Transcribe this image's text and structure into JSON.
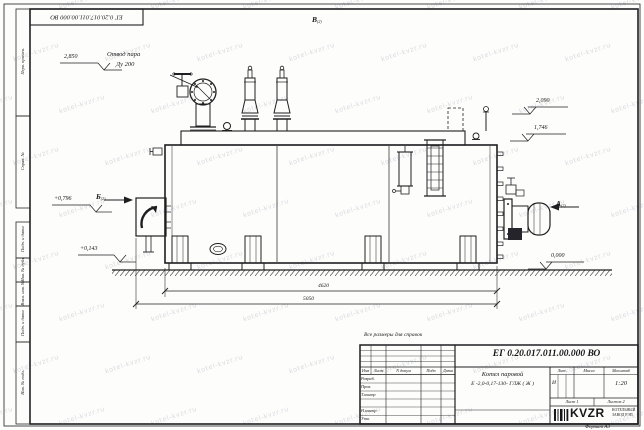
{
  "watermark": {
    "text": "kotel-kvzr.ru"
  },
  "corner_stamp": {
    "doc_number": "ЕГ 0.20.017.011.00.000  ВО"
  },
  "margin": {
    "boxes": [
      {
        "label": "Перв. примен."
      },
      {
        "label": "Справ. №"
      },
      {
        "label": "Подп. и дата"
      },
      {
        "label": "Инв. № дубл."
      },
      {
        "label": "Взам. инв. №"
      },
      {
        "label": "Подп. и дата"
      },
      {
        "label": "Инв. № подл."
      }
    ]
  },
  "views": {
    "top": {
      "letter": "В",
      "sheet": "(2)"
    },
    "left": {
      "letter": "Б",
      "sheet": "(2)"
    },
    "right": {
      "letter": "А",
      "sheet": "(2)"
    }
  },
  "callouts": {
    "steam_line1": "Отвод пара",
    "steam_line2": "Ду 200"
  },
  "levels": {
    "steam": "2,850",
    "top": "2,090",
    "shell": "1,746",
    "left_upper": "+0,796",
    "left_lower": "+0,143",
    "ground": "0,000"
  },
  "dimensions": {
    "inner": "4620",
    "overall": "5050"
  },
  "notes": {
    "reference": "Все размеры для справок"
  },
  "title_block": {
    "doc_number": "ЕГ 0.20.017.011.00.000  ВО",
    "product_name_line1": "Котел паровой",
    "product_name_line2": "Е -2,0-0,17-130- ГЛЖ ( Ж )",
    "columns": {
      "izm": "Изм",
      "list": "Лист",
      "n_docum": "N докум",
      "podp": "Подп",
      "data": "Дата"
    },
    "roles": {
      "razrab": "Разраб.",
      "prov": "Пров.",
      "tkontr": "Т.контр",
      "nkontr": "Н.контр",
      "utv": "Утв."
    },
    "lit_label": "Лит.",
    "massa_label": "Масса",
    "masshtab_label": "Масштаб",
    "lit_value": "И",
    "scale_value": "1:20",
    "sheet_label": "Лист 1",
    "sheets_label": "Листов 2",
    "logo_text": "KVZR",
    "org_name_line1": "КОТЕЛЬНЫЙ",
    "org_name_line2": "ЗАВОД РЭП",
    "format_label": "Формат А3"
  }
}
